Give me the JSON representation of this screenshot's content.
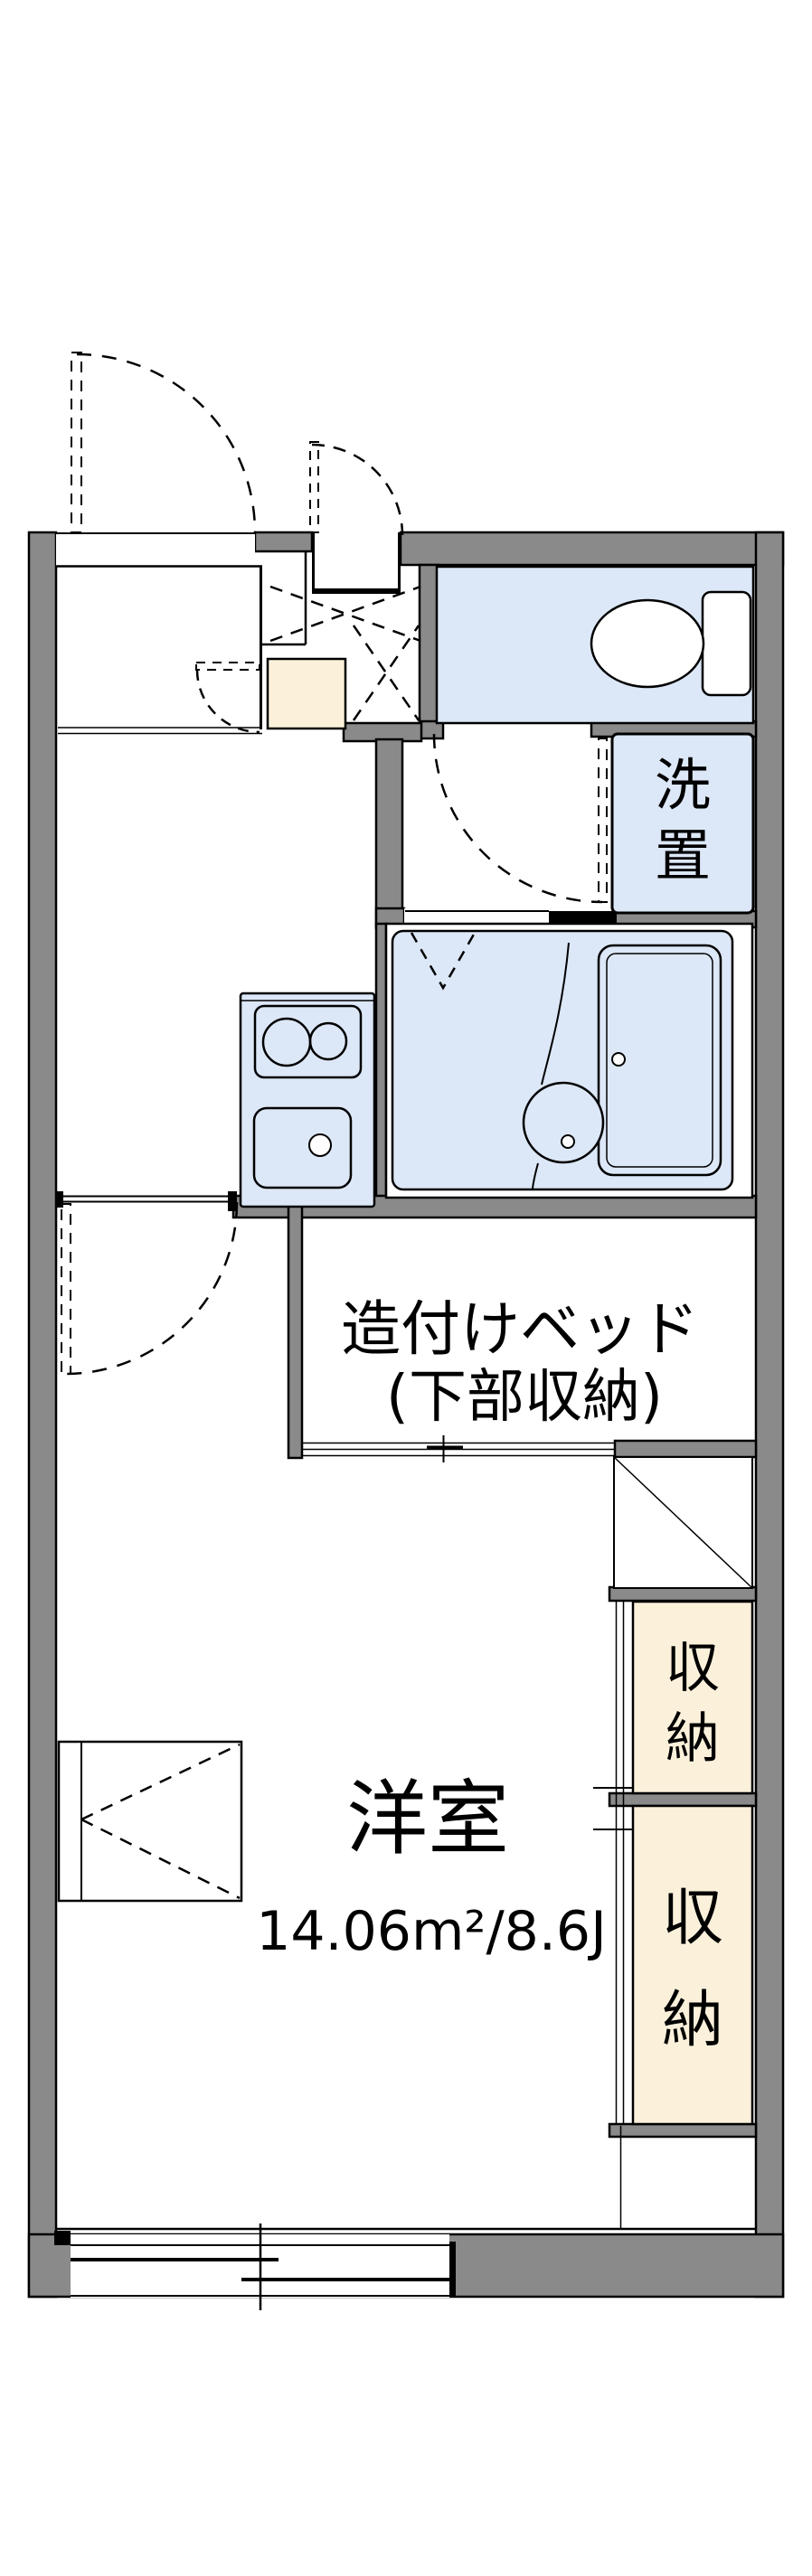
{
  "colors": {
    "wall_gray": "#8a8a8a",
    "water_blue": "#dce7f7",
    "storage_beige": "#fbf1db",
    "line_black": "#000000",
    "floor_white": "#ffffff"
  },
  "plan": {
    "rooms": {
      "western_room": {
        "label": "洋室",
        "area": "14.06m²/8.6J"
      },
      "built_in_bed": {
        "label_line1": "造付けベッド",
        "label_line2": "(下部収納)"
      },
      "washer_space": {
        "chars": [
          "洗",
          "置"
        ]
      },
      "storage_upper": {
        "chars": [
          "収",
          "納"
        ]
      },
      "storage_lower": {
        "chars": [
          "収",
          "納"
        ]
      }
    }
  }
}
